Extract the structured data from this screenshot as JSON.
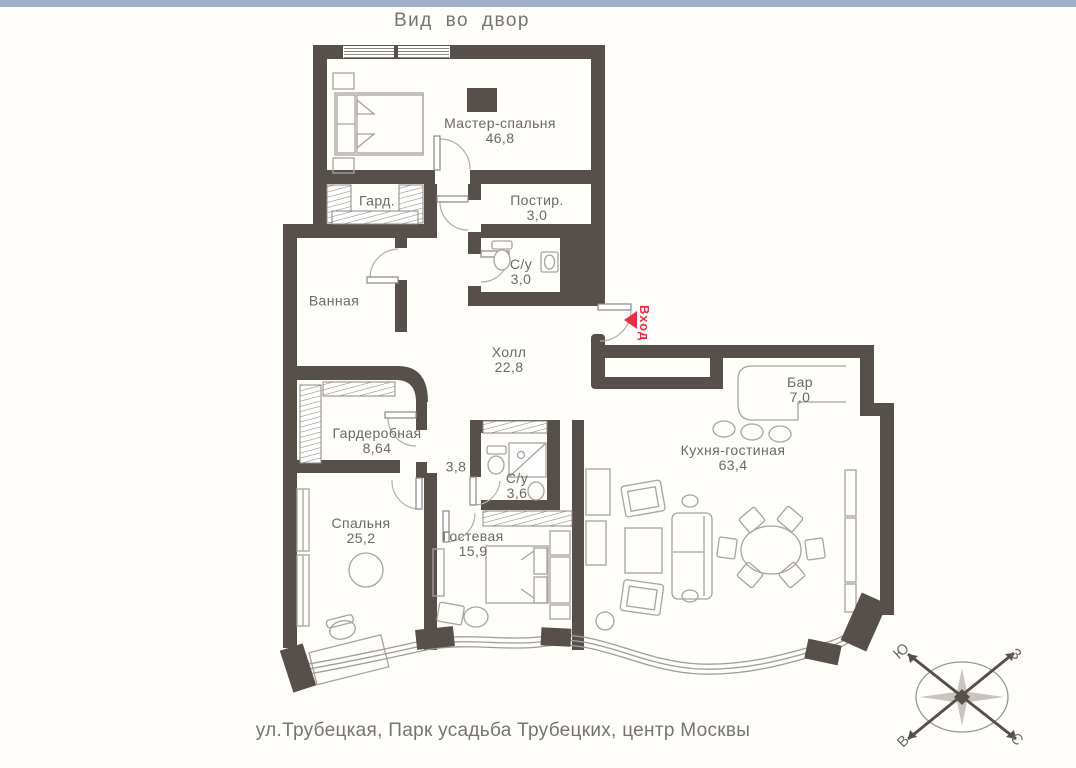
{
  "page": {
    "view_title": "Вид во двор",
    "address": "ул.Трубецкая, Парк усадьба Трубецких, центр Москвы",
    "top_bar_color": "#9fb1ca",
    "background_color": "#fffefa"
  },
  "entrance": {
    "label": "Вход",
    "color": "#e63049"
  },
  "rooms": [
    {
      "name": "Мастер-спальня",
      "area": "46,8"
    },
    {
      "name": "Гард.",
      "area": ""
    },
    {
      "name": "Постир.",
      "area": "3,0"
    },
    {
      "name": "С/у",
      "area": "3,0"
    },
    {
      "name": "Ванная",
      "area": ""
    },
    {
      "name": "Холл",
      "area": "22,8"
    },
    {
      "name": "Бар",
      "area": "7,0"
    },
    {
      "name": "Кухня-гостиная",
      "area": "63,4"
    },
    {
      "name": "Гардеробная",
      "area": "8,64"
    },
    {
      "name": "",
      "area": "3,8"
    },
    {
      "name": "С/у",
      "area": "3,6"
    },
    {
      "name": "Спальня",
      "area": "25,2"
    },
    {
      "name": "Гостевая",
      "area": "15,9"
    }
  ],
  "compass": {
    "north": "С",
    "south": "Ю",
    "west": "З",
    "east": "В"
  },
  "colors": {
    "wall": "#57504a",
    "furniture_line": "#a8a39d",
    "hatch_line": "#8d8780",
    "door_arc": "#b2ada7",
    "label_text": "#6d6862",
    "accent_red": "#e63049"
  }
}
